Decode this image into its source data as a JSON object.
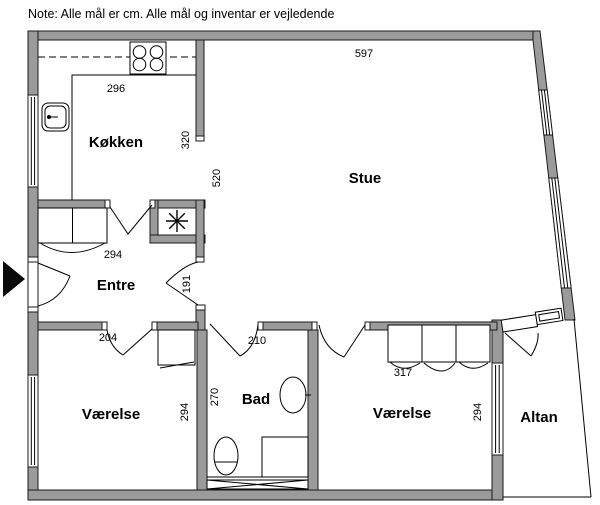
{
  "note": "Note: Alle mål er cm. Alle mål og inventar er vejledende",
  "rooms": {
    "kokken": "Køkken",
    "stue": "Stue",
    "entre": "Entre",
    "bad": "Bad",
    "vaerelse_left": "Værelse",
    "vaerelse_right": "Værelse",
    "altan": "Altan"
  },
  "dimensions": {
    "stue_width": "597",
    "kokken_width": "296",
    "kokken_depth": "320",
    "stue_depth": "520",
    "entre_width": "294",
    "entre_passage": "191",
    "vaerelse_left_door": "204",
    "vaerelse_left_depth": "294",
    "bad_door": "210",
    "bad_width": "270",
    "wardrobe_width": "317",
    "vaerelse_right_depth": "294"
  },
  "icons": {
    "entrance_arrow": "black triangle marking main entrance",
    "stove": "4-burner cooktop",
    "kitchen_sink": "kitchen sink with tap",
    "ventilation_star": "shaft/ventilation asterisk symbol",
    "washbasin": "bathroom round basin",
    "toilet": "toilet",
    "shower": "shower square",
    "radiator": "crossed radiator strip"
  },
  "colors": {
    "wall_fill": "#9b9b9b",
    "outline": "#1a1a1a",
    "background": "#ffffff"
  }
}
